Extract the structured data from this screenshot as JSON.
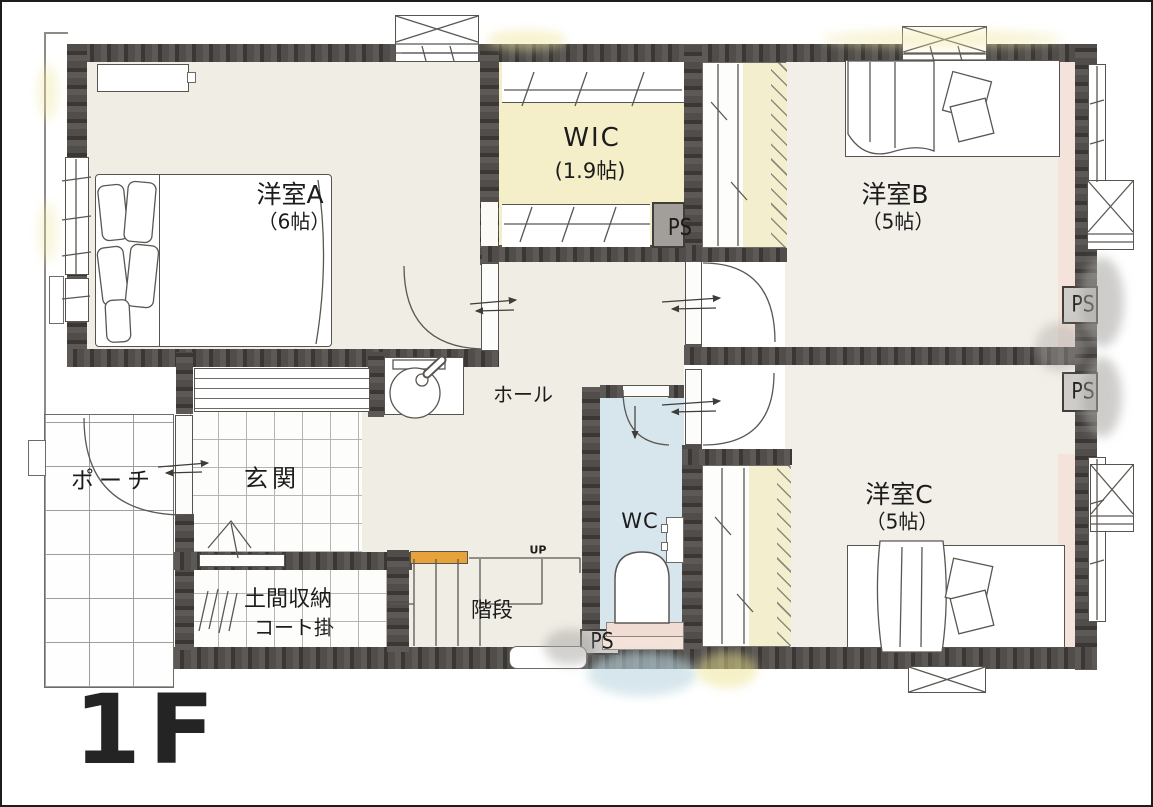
{
  "floor": {
    "label": "1F"
  },
  "rooms": {
    "room_a": {
      "name": "洋室A",
      "size": "（6帖）"
    },
    "wic": {
      "name": "WIC",
      "size": "(1.9帖)"
    },
    "room_b": {
      "name": "洋室B",
      "size": "（5帖）"
    },
    "room_c": {
      "name": "洋室C",
      "size": "（5帖）"
    },
    "hall": {
      "name": "ホール"
    },
    "entrance": {
      "name": "玄関"
    },
    "porch": {
      "name": "ポーチ"
    },
    "doma_storage": {
      "name": "土間収納",
      "sub": "コート掛"
    },
    "stairs": {
      "name": "階段",
      "direction": "UP"
    },
    "wc": {
      "name": "WC"
    }
  },
  "ps_label": "PS",
  "colors": {
    "wall": "#4a4643",
    "floor_beige": "#f0ede5",
    "wic_floor": "#f4efc9",
    "wc_floor": "#d6e6ec",
    "accent_pink": "#f4e3da",
    "handrail_orange": "#e8a23c"
  }
}
